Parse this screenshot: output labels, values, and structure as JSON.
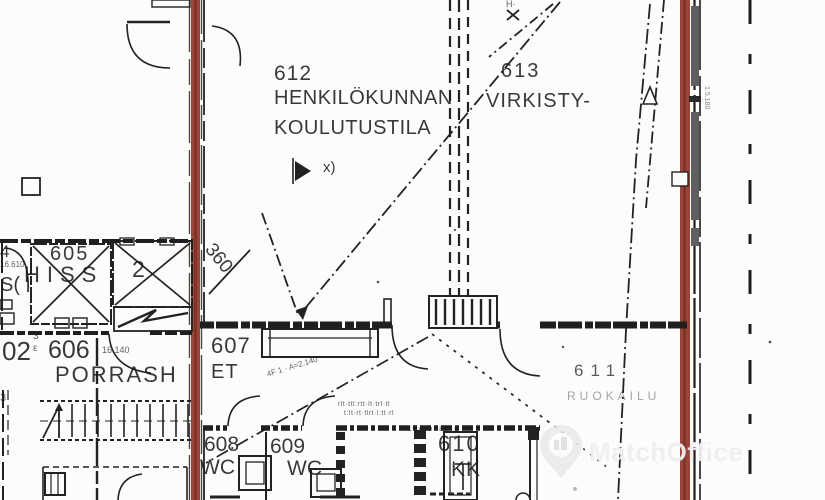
{
  "document": {
    "type": "scanned-floor-plan",
    "floor_number_series": "600"
  },
  "labels": {
    "r612_number": "612",
    "r612_name1": "HENKILÖKUNNAN",
    "r612_name2": "KOULUTUSTILA",
    "r612_note": "x)",
    "r613_number": "613",
    "r613_name": "VIRKISTY-",
    "r605_number": "605",
    "r605_name": "HISS",
    "shaft2_number": "2",
    "r606_number": "606",
    "r606_level": "16.140",
    "r606_name": "PORRASH",
    "r607_number": "607",
    "r607_name": "ET",
    "r608_number": "608",
    "r608_name": "WC",
    "r609_number": "609",
    "r609_name": "WC",
    "r610_number": "610",
    "r610_name": "KK",
    "r611_number": "611",
    "r611_name": "RUOKAILU",
    "dim_360": "360",
    "frag_602": "02",
    "frag_604": "4",
    "frag_604_level": "16.610",
    "frag_hissi": "S(",
    "door_mark_3": "3",
    "door_mark_e": "ε",
    "stair_mark_3": "3",
    "note_h": "H·",
    "note_4f": "4F 1 · A=2.140",
    "tiny_row_1": "rlt·ttl:rtt·lt·trl·tl",
    "tiny_row_2": "t:lt·rt·tlrt·l:tt·rl",
    "tiny_row_3": "ε÷»ɔɔ=εʊ↓ε",
    "tiny_right_vertical": "1.5.180"
  },
  "watermark": {
    "text": "MatchOffice"
  },
  "colors": {
    "highlight_wall": "#99453a",
    "highlight_wall_core": "#7c3128",
    "ink": "#1e1e1e",
    "window_gray": "#5f5f5f",
    "paper": "#fcfcfa",
    "watermark_text": "#eeeeee"
  }
}
